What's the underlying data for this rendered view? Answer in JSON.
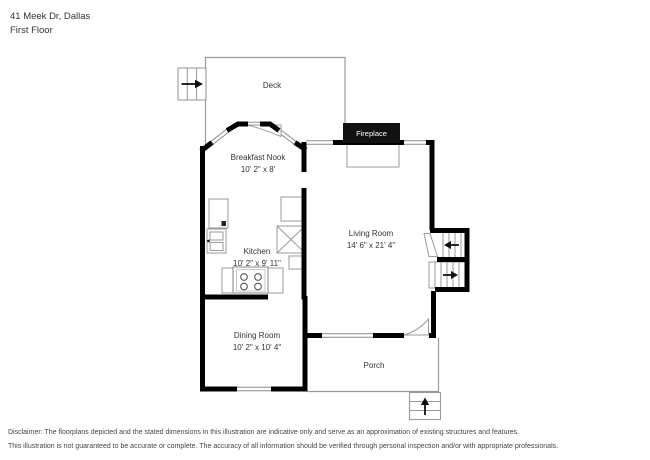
{
  "header": {
    "address": "41 Meek Dr, Dallas",
    "floor_label": "First Floor"
  },
  "plan": {
    "fireplace_label": "Fireplace",
    "rooms": {
      "deck": {
        "name": "Deck",
        "dims": ""
      },
      "breakfast_nook": {
        "name": "Breakfast Nook",
        "dims": "10' 2\" x 8'"
      },
      "kitchen": {
        "name": "Kitchen",
        "dims": "10' 2\" x 9' 11\""
      },
      "living_room": {
        "name": "Living Room",
        "dims": "14' 6\" x 21' 4\""
      },
      "dining_room": {
        "name": "Dining Room",
        "dims": "10' 2\" x 10' 4\""
      },
      "porch": {
        "name": "Porch",
        "dims": ""
      }
    },
    "icons": {
      "deck_stairs": "stairs-arrow-right",
      "upper_stairs": "stairs-arrow-left",
      "lower_stairs": "stairs-arrow-right",
      "porch_stairs": "stairs-arrow-up"
    }
  },
  "disclaimer": {
    "line1": "Disclaimer: The floorplans depicted and the stated dimensions in this illustration are indicative only and serve as an approximation of existing structures and features.",
    "line2": "This illustration is not guaranteed to be accurate or complete. The accuracy of all information should be verified through personal inspection and/or with appropriate professionals."
  },
  "colors": {
    "wall": "#000000",
    "outline": "#999999",
    "text": "#333333",
    "fireplace_bg": "#111111"
  }
}
